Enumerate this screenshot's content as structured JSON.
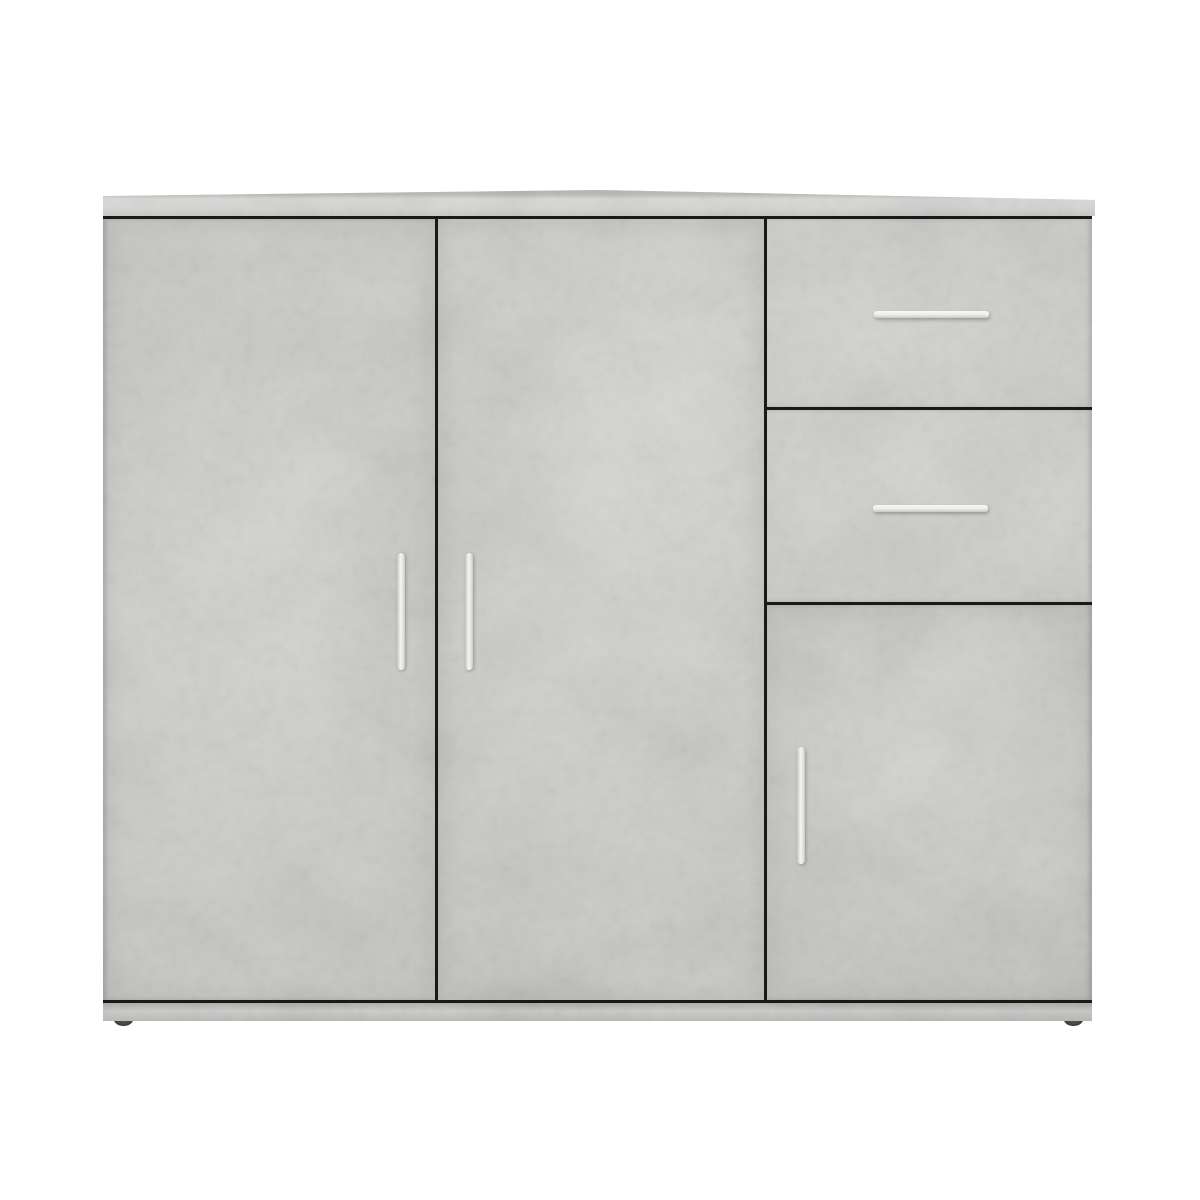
{
  "scene": {
    "type": "product-photo",
    "subject": "sideboard cabinet with 3 doors and 2 drawers",
    "finish": "concrete grey",
    "background_color": "#ffffff",
    "text_visible": "none"
  },
  "palette": {
    "concrete_base": "#b9bab6",
    "concrete_light_patch": "#cdcec9",
    "concrete_dark_patch": "#a5a6a2",
    "top_board": "#c2c3bf",
    "seam_line": "#191917",
    "handle_silver": "#ececea",
    "foot_dark": "#3b3b39"
  },
  "components": {
    "top_board": {
      "label": "top board",
      "overhang": "slight right overhang"
    },
    "doors": [
      {
        "id": "left-door",
        "label": "left hinged door",
        "handle": "vertical silver bar"
      },
      {
        "id": "middle-door",
        "label": "middle hinged door",
        "handle": "vertical silver bar"
      },
      {
        "id": "bottom-right-door",
        "label": "bottom right hinged door",
        "handle": "vertical silver bar"
      }
    ],
    "drawers": [
      {
        "id": "top-drawer",
        "label": "top right drawer",
        "handle": "horizontal silver bar"
      },
      {
        "id": "middle-drawer",
        "label": "middle right drawer",
        "handle": "horizontal silver bar"
      }
    ],
    "plinth": {
      "label": "base plinth"
    },
    "feet": [
      {
        "id": "left-foot",
        "label": "front left foot"
      },
      {
        "id": "right-foot",
        "label": "front right foot"
      }
    ]
  }
}
